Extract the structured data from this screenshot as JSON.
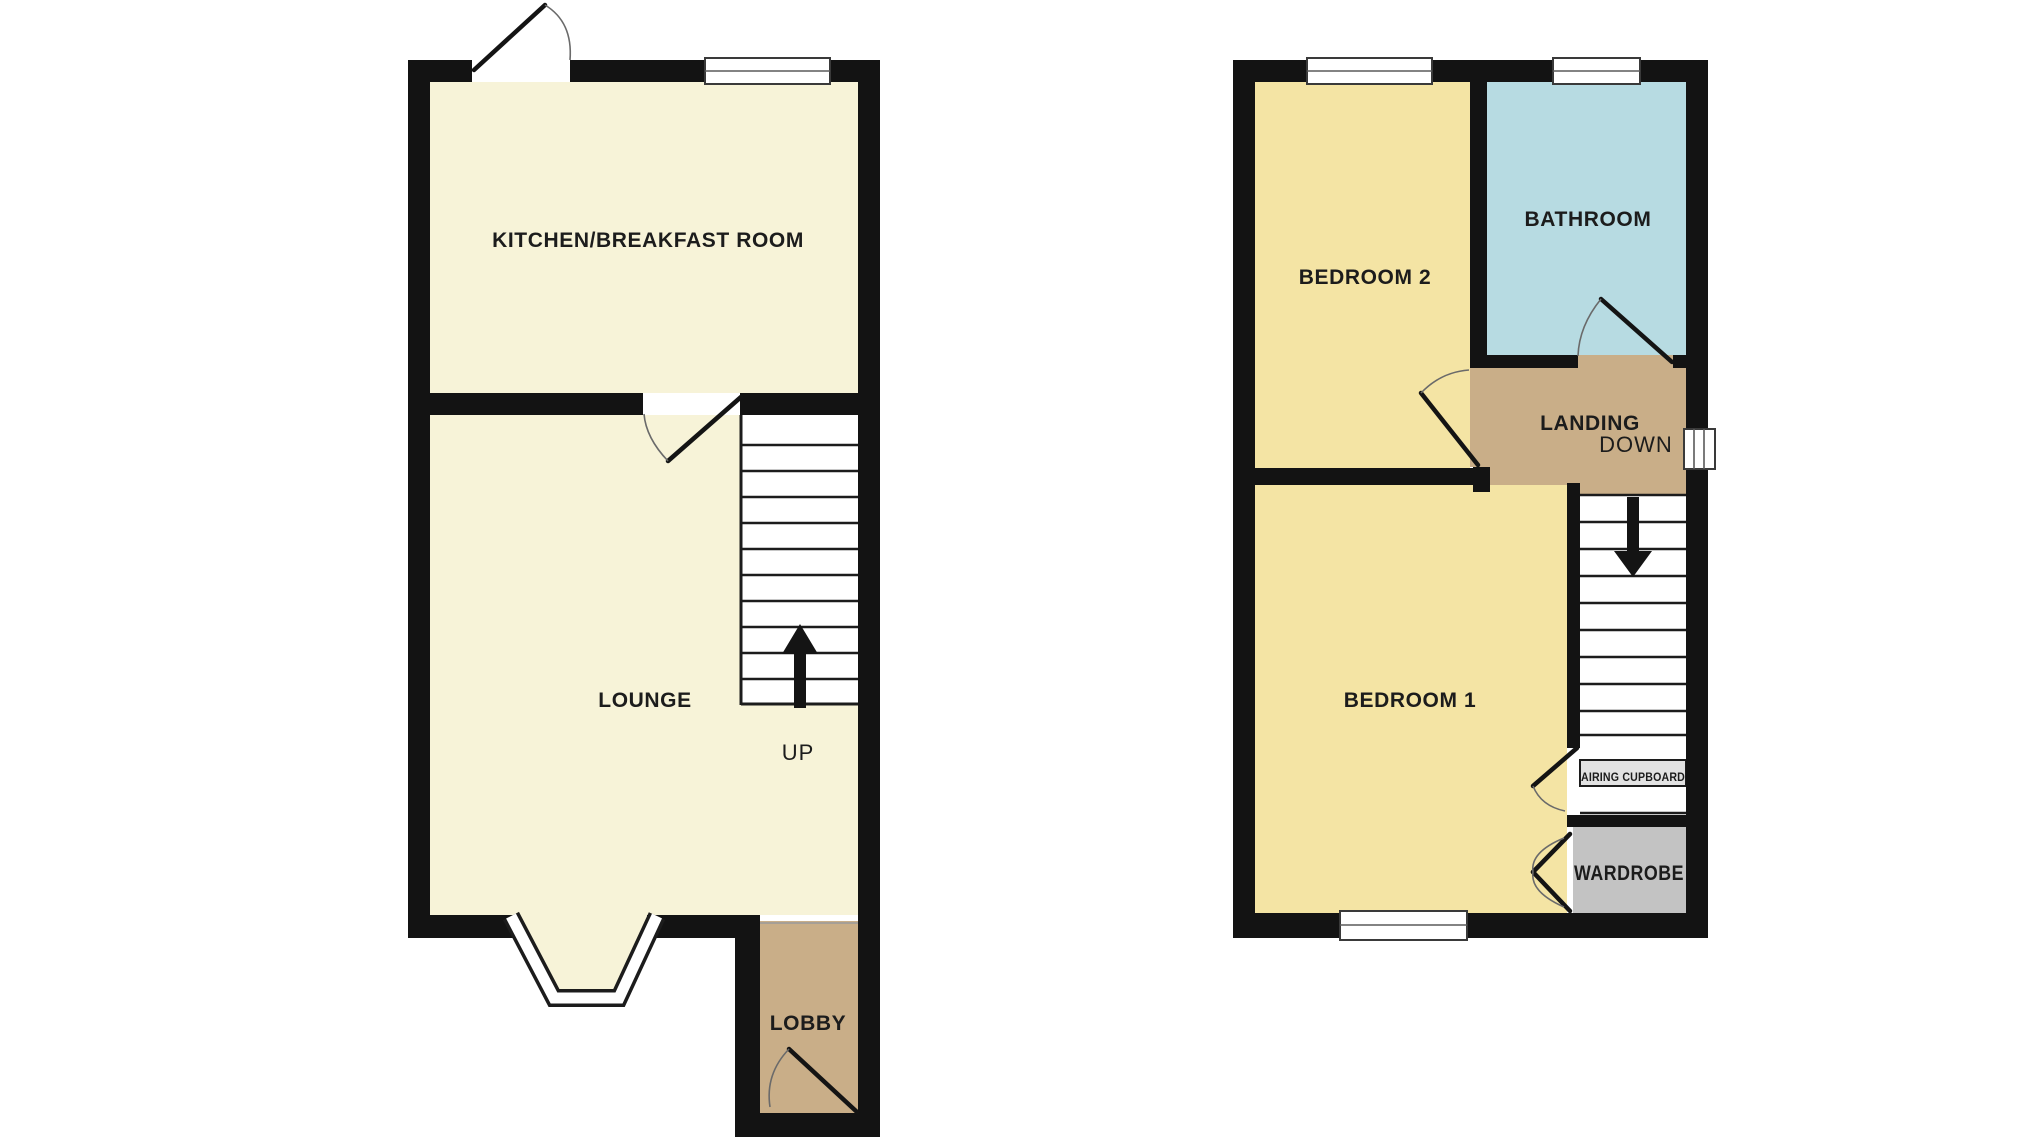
{
  "document": {
    "type": "floorplan",
    "background": "#ffffff"
  },
  "colors": {
    "wall": "#131313",
    "floor_cream": "#f7f3d8",
    "floor_yellow": "#f4e4a4",
    "floor_blue": "#b7dbe2",
    "floor_tan": "#c9ae88",
    "floor_gray": "#c3c3c3",
    "window_white": "#ffffff",
    "cupboard_band": "#e2e2e2"
  },
  "ground_floor": {
    "kitchen_label": "KITCHEN/BREAKFAST ROOM",
    "lounge_label": "LOUNGE",
    "lobby_label": "LOBBY",
    "stairs_direction": "UP"
  },
  "first_floor": {
    "bedroom2_label": "BEDROOM 2",
    "bathroom_label": "BATHROOM",
    "landing_label": "LANDING",
    "stairs_direction": "DOWN",
    "bedroom1_label": "BEDROOM 1",
    "airing_cupboard_label": "AIRING CUPBOARD",
    "wardrobe_label": "WARDROBE"
  }
}
